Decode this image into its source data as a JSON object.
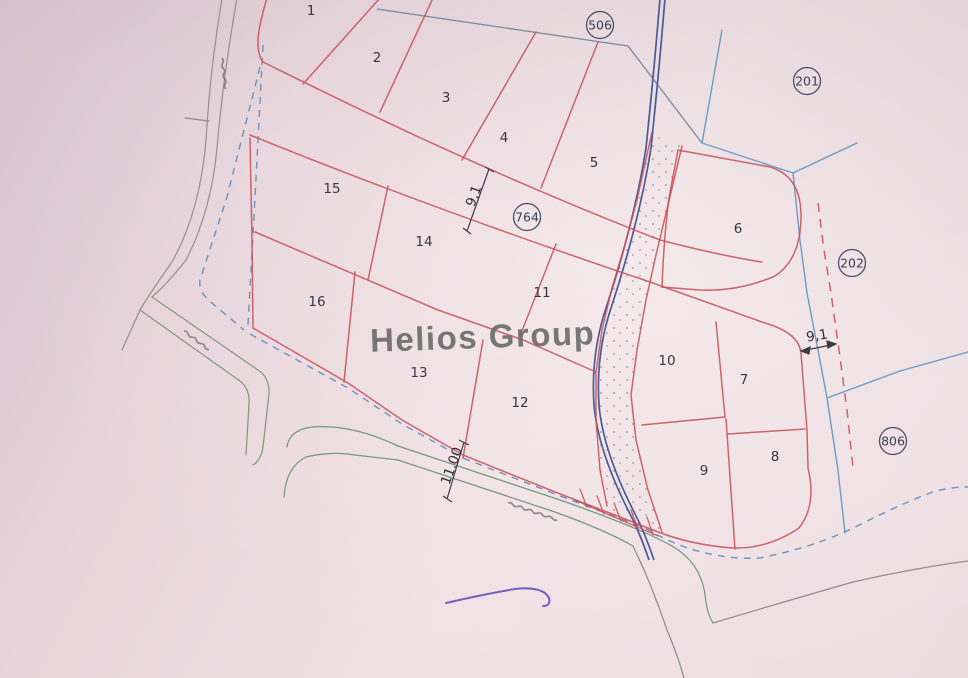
{
  "map": {
    "watermark": {
      "text": "Helios Group"
    },
    "plot_numbers": [
      {
        "label": "1",
        "x": 311,
        "y": 11
      },
      {
        "label": "2",
        "x": 377,
        "y": 58
      },
      {
        "label": "3",
        "x": 446,
        "y": 98
      },
      {
        "label": "4",
        "x": 504,
        "y": 138
      },
      {
        "label": "5",
        "x": 594,
        "y": 163
      },
      {
        "label": "6",
        "x": 738,
        "y": 229
      },
      {
        "label": "7",
        "x": 744,
        "y": 380
      },
      {
        "label": "8",
        "x": 775,
        "y": 457
      },
      {
        "label": "9",
        "x": 704,
        "y": 471
      },
      {
        "label": "10",
        "x": 667,
        "y": 361
      },
      {
        "label": "11",
        "x": 542,
        "y": 293
      },
      {
        "label": "12",
        "x": 520,
        "y": 403
      },
      {
        "label": "13",
        "x": 419,
        "y": 373
      },
      {
        "label": "14",
        "x": 424,
        "y": 242
      },
      {
        "label": "15",
        "x": 332,
        "y": 189
      },
      {
        "label": "16",
        "x": 317,
        "y": 302
      }
    ],
    "survey_markers": [
      {
        "label": "506",
        "x": 600,
        "y": 25
      },
      {
        "label": "201",
        "x": 807,
        "y": 81
      },
      {
        "label": "764",
        "x": 527,
        "y": 217
      },
      {
        "label": "202",
        "x": 852,
        "y": 263
      },
      {
        "label": "806",
        "x": 893,
        "y": 441
      }
    ],
    "measurements": [
      {
        "label": "9,1",
        "x": 474,
        "y": 196,
        "rot": -70
      },
      {
        "label": "11.00",
        "x": 452,
        "y": 466,
        "rot": -70
      },
      {
        "label": "9,1",
        "x": 817,
        "y": 336,
        "rot": -9
      }
    ],
    "road_labels": [
      {
        "x": 222,
        "y": 58,
        "rot": 83,
        "len": 22
      },
      {
        "x": 184,
        "y": 331,
        "rot": 37,
        "len": 26
      },
      {
        "x": 508,
        "y": 503,
        "rot": 19,
        "len": 42
      }
    ]
  },
  "colors": {
    "parcel_red": "#c8515c",
    "red_dashed": "#d4606a",
    "stream_blue": "#4d5a94",
    "boundary_blue": "#6f9cc4",
    "gray_blue": "#7b8aa0",
    "dashed_blue": "#6a94bd",
    "road_gray": "#98928f",
    "road_green": "#79997f",
    "stipple": "#8494a6",
    "ink": "#5b49bb",
    "text_dark": "#363745",
    "watermark_gray": "#6e6e6e"
  }
}
